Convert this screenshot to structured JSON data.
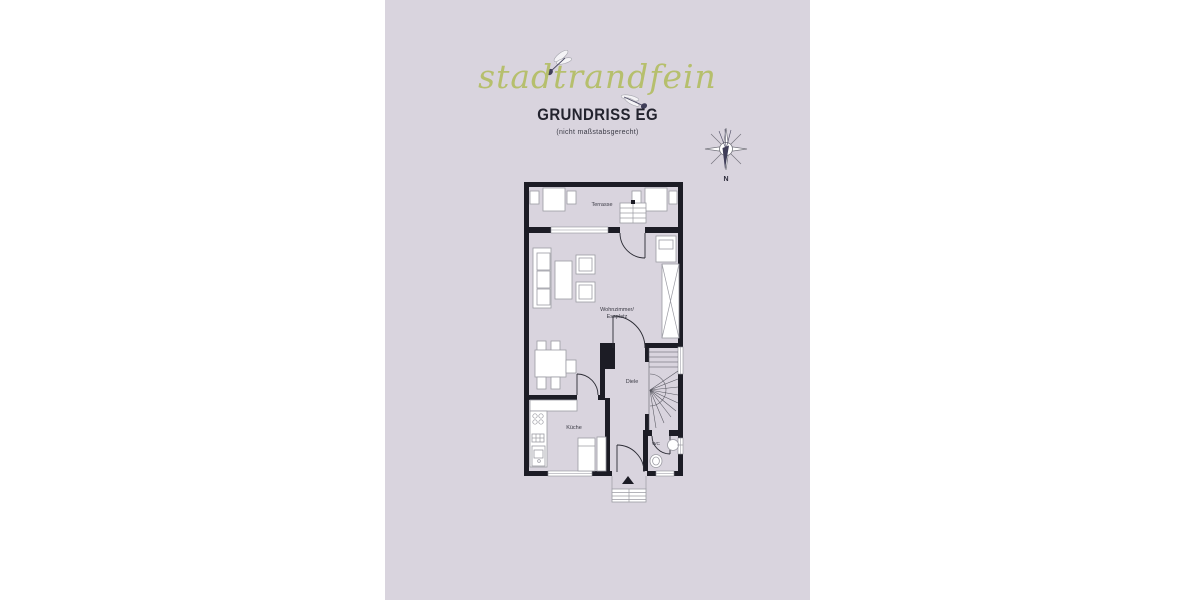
{
  "header": {
    "brand": "stadtrandfein",
    "title": "GRUNDRISS EG",
    "subtitle": "(nicht maßstabsgerecht)"
  },
  "compass": {
    "north_label": "N"
  },
  "floorplan": {
    "rooms": {
      "terrasse": "Terrasse",
      "wohnzimmer_line1": "Wohnzimmer/",
      "wohnzimmer_line2": "Essplatz",
      "diele": "Diele",
      "kueche": "Küche",
      "wc": "WC"
    }
  },
  "colors": {
    "page_bg": "#ffffff",
    "panel_bg": "#d9d4de",
    "logo_green": "#b6bf6d",
    "ink": "#23232e",
    "wall": "#1c1c25",
    "furniture_stroke": "#9b9ba3",
    "accent_dark": "#403e59"
  }
}
